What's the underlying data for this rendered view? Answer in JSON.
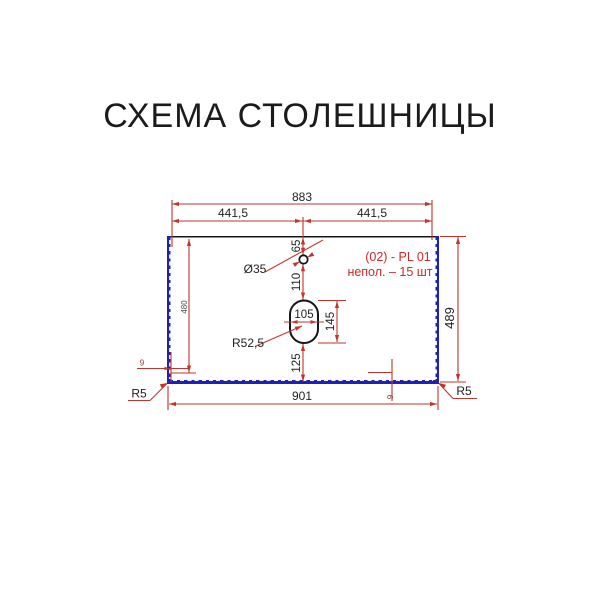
{
  "title": "СХЕМА СТОЛЕШНИЦЫ",
  "colors": {
    "dimension_red": "#c0362e",
    "edge_blue": "#2020b2",
    "outline_black": "#161616",
    "banding_dash": "#eef0ff",
    "note_red": "#cc2a28"
  },
  "dimensions": {
    "total_width": "883",
    "half_width_left": "441,5",
    "half_width_right": "441,5",
    "hole_top_offset": "65",
    "hole_diameter": "Ø35",
    "hole_to_cutout": "110",
    "cutout_width": "105",
    "cutout_height": "145",
    "cutout_corner_radius": "R52,5",
    "cutout_bottom_offset": "125",
    "left_height": "480",
    "right_height": "489",
    "bottom_width": "901",
    "corner_radius_left": "R5",
    "corner_radius_right": "R5",
    "edge_offset_left": "9",
    "edge_offset_bottom": "9"
  },
  "note": {
    "line1": "(02) - PL 01",
    "line2": "непол. – 15 шт"
  }
}
